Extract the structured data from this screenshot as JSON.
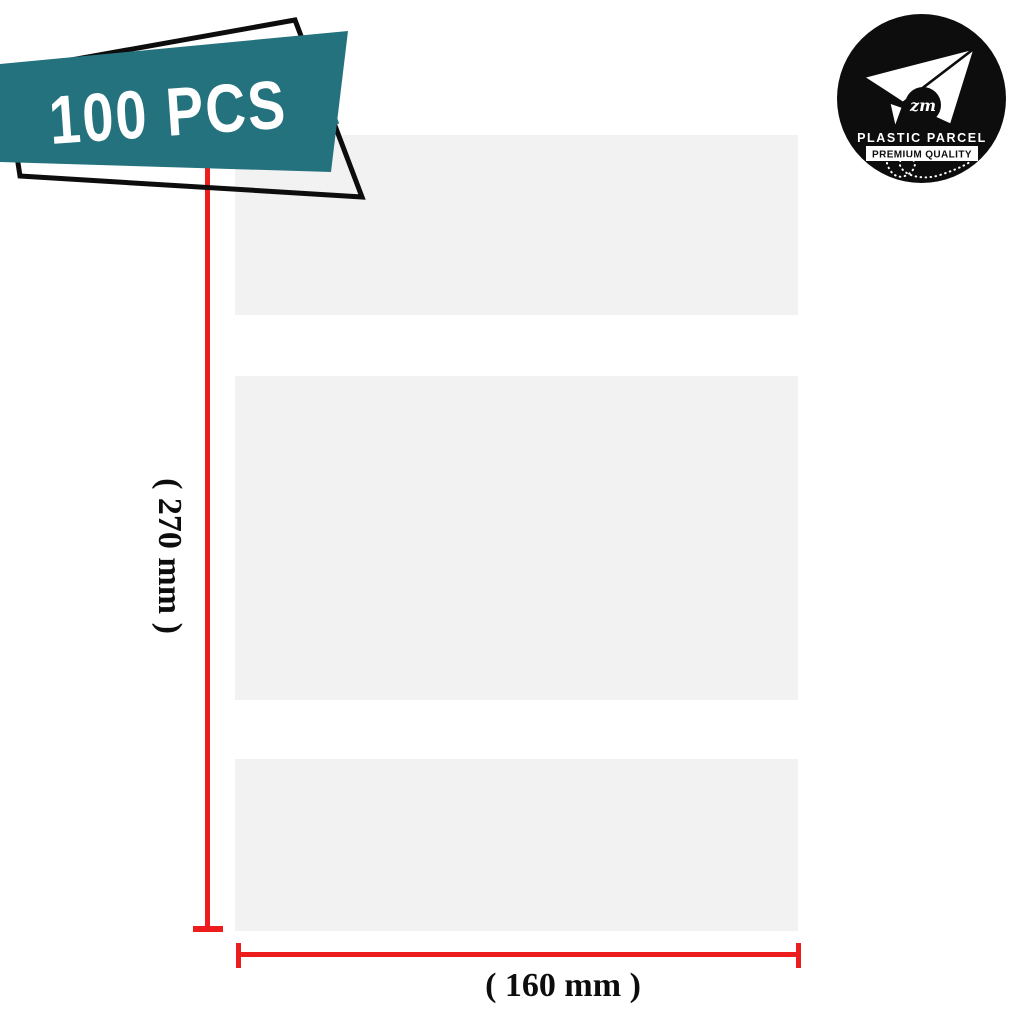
{
  "badge": {
    "label": "100 PCS"
  },
  "logo": {
    "brand": "PLASTIC PARCEL",
    "tagline": "PREMIUM QUALITY",
    "monogram": "zm"
  },
  "dimensions": {
    "height_label": "( 270 mm )",
    "width_label": "( 160 mm )"
  },
  "colors": {
    "teal": "#24727E",
    "red": "#EE1D1D",
    "bag": "#F2F2F2",
    "stripe": "#FFFFFF",
    "ink": "#0D0D0D"
  }
}
